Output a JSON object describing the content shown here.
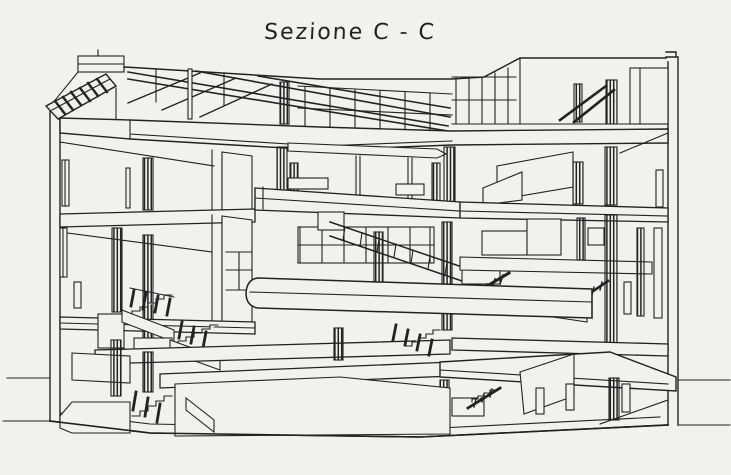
{
  "title": "Sezione C - C",
  "drawing": {
    "name": "building-section-perspective",
    "label": "Sezione C - C"
  },
  "colors": {
    "paper": "#f1f1ef",
    "ink": "#222222"
  }
}
